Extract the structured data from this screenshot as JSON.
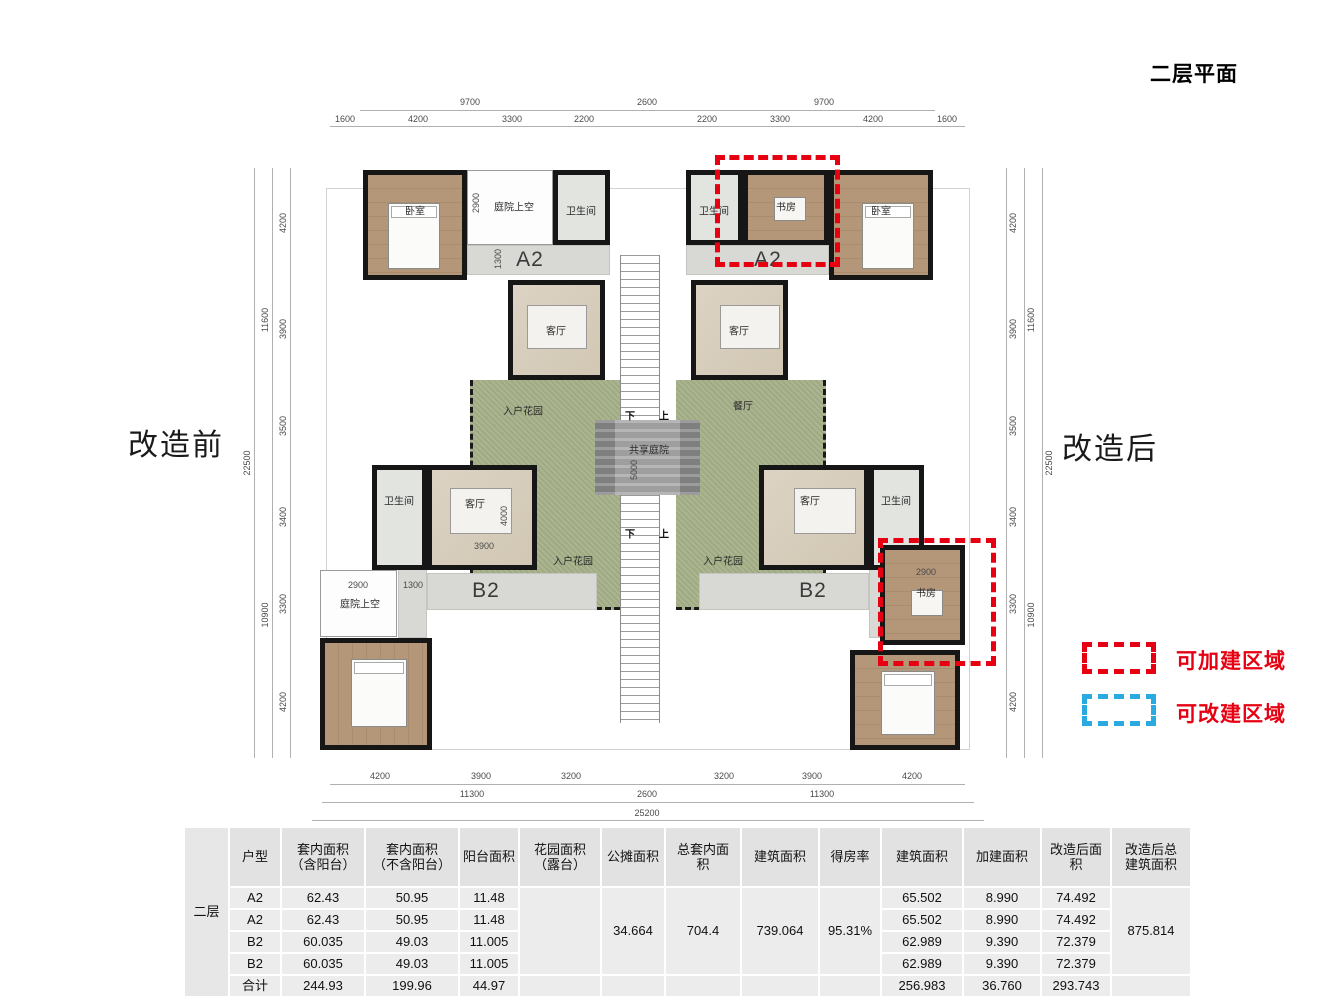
{
  "title": "二层平面",
  "before_label": "改造前",
  "after_label": "改造后",
  "legend": {
    "add_label": "可加建区域",
    "modify_label": "可改建区域",
    "add_color": "#e60012",
    "modify_color": "#29abe2"
  },
  "plan": {
    "units": {
      "a2": "A2",
      "b2": "B2"
    },
    "rooms": {
      "bedroom": "卧室",
      "study": "书房",
      "bath": "卫生间",
      "living": "客厅",
      "dining": "餐厅",
      "entry_garden": "入户花园",
      "courtyard_void": "庭院上空",
      "shared_courtyard": "共享庭院"
    },
    "stairs": {
      "down": "下",
      "up": "上"
    },
    "inner": {
      "void_tl": "2900",
      "hall_tl": "1300",
      "living_bl_h": "4000",
      "living_bl_w": "3900",
      "void_bl": "2900",
      "hall_bl": "1300",
      "study_br": "2900",
      "courtyard_h": "5000"
    },
    "dims": {
      "top_groups": [
        "9700",
        "2600",
        "9700"
      ],
      "top_segs": [
        "1600",
        "4200",
        "3300",
        "2200",
        "2200",
        "3300",
        "4200",
        "1600"
      ],
      "bottom_segs": [
        "4200",
        "3900",
        "3200",
        "3200",
        "3900",
        "4200"
      ],
      "bottom_groups": [
        "11300",
        "2600",
        "11300"
      ],
      "bottom_total": "25200",
      "left_segs": [
        "4200",
        "3900",
        "3500",
        "3400",
        "3300",
        "4200"
      ],
      "left_groups": [
        "11600",
        "10900"
      ],
      "left_total": "22500",
      "right_segs": [
        "4200",
        "3900",
        "3500",
        "3400",
        "3300",
        "4200"
      ],
      "right_groups": [
        "11600",
        "10900"
      ],
      "right_total": "22500"
    }
  },
  "table": {
    "group_label": "二层",
    "headers": [
      "户型",
      "套内面积\n（含阳台）",
      "套内面积\n（不含阳台）",
      "阳台面积",
      "花园面积\n（露台）",
      "公摊面积",
      "总套内面\n积",
      "建筑面积",
      "得房率",
      "建筑面积",
      "加建面积",
      "改造后面\n积",
      "改造后总\n建筑面积"
    ],
    "merged": {
      "shared_area": "34.664",
      "total_inner_area": "704.4",
      "construction_area": "739.064",
      "efficiency": "95.31%",
      "total_after": "875.814"
    },
    "rows": [
      {
        "type": "A2",
        "c1": "62.43",
        "c2": "50.95",
        "c3": "11.48",
        "c9": "65.502",
        "c10": "8.990",
        "c11": "74.492"
      },
      {
        "type": "A2",
        "c1": "62.43",
        "c2": "50.95",
        "c3": "11.48",
        "c9": "65.502",
        "c10": "8.990",
        "c11": "74.492"
      },
      {
        "type": "B2",
        "c1": "60.035",
        "c2": "49.03",
        "c3": "11.005",
        "c9": "62.989",
        "c10": "9.390",
        "c11": "72.379"
      },
      {
        "type": "B2",
        "c1": "60.035",
        "c2": "49.03",
        "c3": "11.005",
        "c9": "62.989",
        "c10": "9.390",
        "c11": "72.379"
      },
      {
        "type": "合计",
        "c1": "244.93",
        "c2": "199.96",
        "c3": "44.97",
        "c9": "256.983",
        "c10": "36.760",
        "c11": "293.743"
      }
    ]
  }
}
